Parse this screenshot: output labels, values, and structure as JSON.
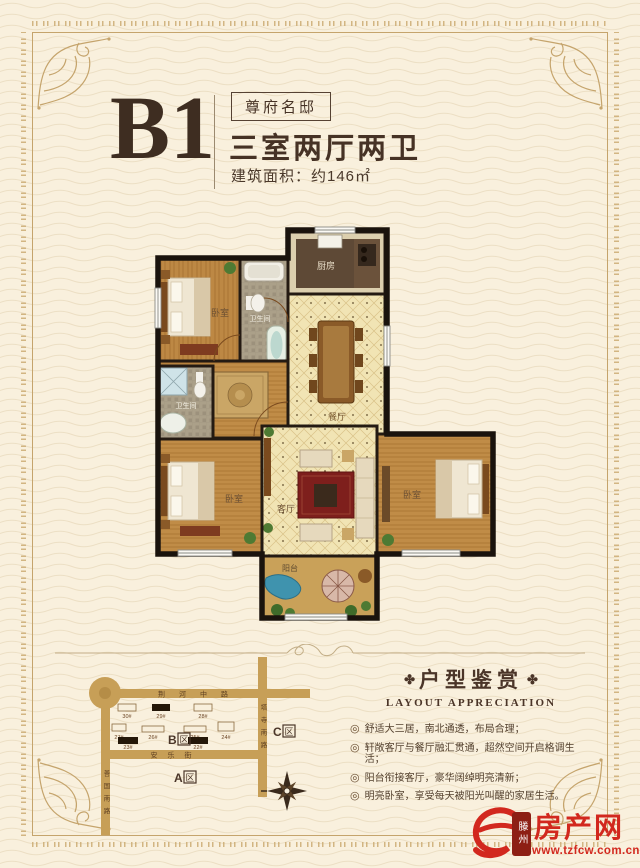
{
  "page": {
    "background": "#f9f0dd",
    "frame_gold": "#c5a46c",
    "ink": "#4a3526",
    "accent_red": "#d2281e"
  },
  "header": {
    "plan_code": "B1",
    "badge": "尊府名邸",
    "layout_text": "三室两厅两卫",
    "area_text": "建筑面积：约146㎡"
  },
  "floor_plan": {
    "labels": {
      "bedroom_top": "卧室",
      "bath_top": "卫生间",
      "kitchen": "厨房",
      "dining": "餐厅",
      "bath_lower": "卫生间",
      "living": "客厅",
      "bedroom_left": "卧室",
      "bedroom_right": "卧室",
      "balcony": "阳台"
    }
  },
  "map": {
    "roads": {
      "north": "荆河中路",
      "west": "善国南路",
      "east": "塔寺南路",
      "middle": "安乐街"
    },
    "zone_suffix": "区",
    "zones": [
      {
        "letter": "A"
      },
      {
        "letter": "B"
      },
      {
        "letter": "C"
      }
    ],
    "buildings": [
      "30#",
      "29#",
      "28#",
      "27#",
      "26#",
      "25#",
      "24#",
      "23#",
      "22#"
    ]
  },
  "appreciation": {
    "title_ornament": "✤",
    "title": "户型鉴赏",
    "subtitle": "LAYOUT APPRECIATION",
    "bullet_icon": "◎",
    "items": [
      "舒适大三居，南北通透，布局合理；",
      "轩敞客厅与餐厅融汇贯通，超然空间开启格调生活；",
      "阳台衔接客厅，豪华阔绰明亮清新；",
      "明亮卧室，享受每天被阳光叫醒的家居生活。"
    ]
  },
  "logo": {
    "city": "滕州",
    "site": "房产网",
    "url": "www.tzfcw.com.cn"
  }
}
